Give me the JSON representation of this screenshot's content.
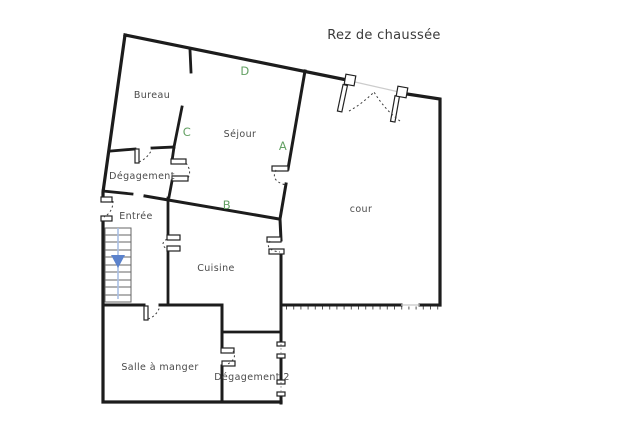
{
  "title": "Rez de chaussée",
  "rooms": {
    "bureau": "Bureau",
    "sejour": "Séjour",
    "degagement": "Dégagement",
    "entree": "Entrée",
    "cuisine": "Cuisine",
    "cour": "cour",
    "salle_a_manger": "Salle à manger",
    "degagement2": "Dégagement 2"
  },
  "zone_letters": {
    "a": "A",
    "b": "B",
    "c": "C",
    "d": "D"
  },
  "colors": {
    "wall": "#1c1c1c",
    "room_label": "#4a4a4a",
    "zone_letter_green": "#63a063",
    "stair_arrow_blue": "#5b82cc",
    "stair_guide_blue": "#a9bfe4",
    "background": "#ffffff"
  }
}
